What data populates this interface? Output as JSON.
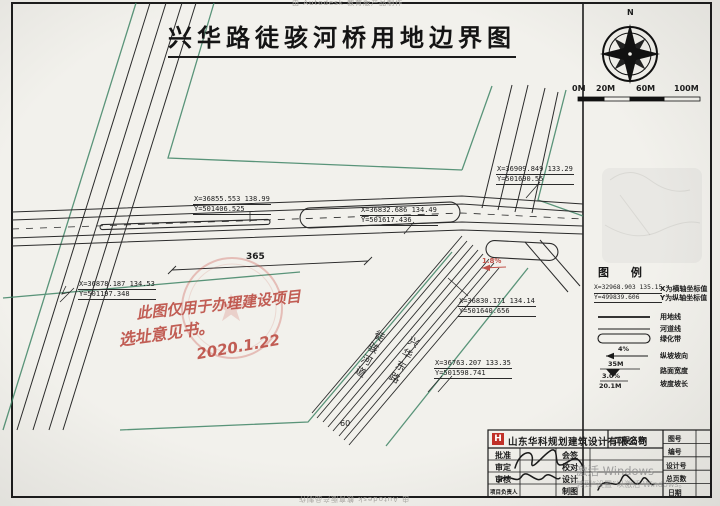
{
  "colors": {
    "paper": "#f2f1ec",
    "ink": "#1c1c1c",
    "green_boundary": "#3f8465",
    "stamp_red": "#c44a3e",
    "watermark_gray": "#919191",
    "logo_red": "#c03028"
  },
  "header": {
    "title": "兴华路徒骇河桥用地边界图",
    "autodesk_top": "由 Autodesk 教育版产品制作",
    "autodesk_bottom": "由 Autodesk 教育版产品制作"
  },
  "compass": {
    "north_label": "N"
  },
  "scalebar": {
    "labels": [
      "0M",
      "20M",
      "60M",
      "100M"
    ]
  },
  "map": {
    "coords": [
      {
        "line1": "X=36855.553 138.99",
        "line2": "Y=501406.525"
      },
      {
        "line1": "X=36832.686 134.49",
        "line2": "Y=501617.436"
      },
      {
        "line1": "X=36909.849 133.29",
        "line2": "Y=501690.55"
      },
      {
        "line1": "X=36878.187 134.53",
        "line2": "Y=501197.348"
      },
      {
        "line1": "X=36830.171 134.14",
        "line2": "Y=501640.656"
      },
      {
        "line1": "X=36763.207 133.35",
        "line2": "Y=501598.741"
      }
    ],
    "dim_365": "365",
    "dim_60": "60",
    "slope_note": "1.8%",
    "river_label": "徒骇河道",
    "road_label": "兴华东路",
    "stamp_note_line1": "此图仅用于办理建设项目",
    "stamp_note_line2": "选址意见书。",
    "stamp_note_date": "2020.1.22",
    "stamp_star": "★"
  },
  "legend": {
    "title": "图 例",
    "sample_coord_line1": "X=32968.903 135.15",
    "sample_coord_line2": "Y=499839.606",
    "items": [
      {
        "label": "X为横轴坐标值"
      },
      {
        "label": "Y为纵轴坐标值"
      },
      {
        "label": "用地线"
      },
      {
        "label": "河道线"
      },
      {
        "label": "绿化带"
      },
      {
        "label": "纵坡坡向",
        "value": "4%"
      },
      {
        "label": "路面宽度",
        "value": "35M"
      },
      {
        "label": "坡度坡长",
        "value_top": "3.0%",
        "value_bottom": "20.1M"
      }
    ]
  },
  "titleblock": {
    "company": "山东华科规划建筑设计有限公司",
    "logo_letter": "H",
    "project_label": "工程名称",
    "left_rows": [
      "批准",
      "审定",
      "审核",
      "项目负责人"
    ],
    "mid_rows": [
      "会签",
      "校对",
      "设计",
      "制图"
    ],
    "right_rows": [
      "图号",
      "编号",
      "设计号",
      "总页数",
      "日期"
    ]
  },
  "watermark": {
    "line1": "激活 Windows",
    "line2": "转到“设置”以激活 Windows。"
  }
}
